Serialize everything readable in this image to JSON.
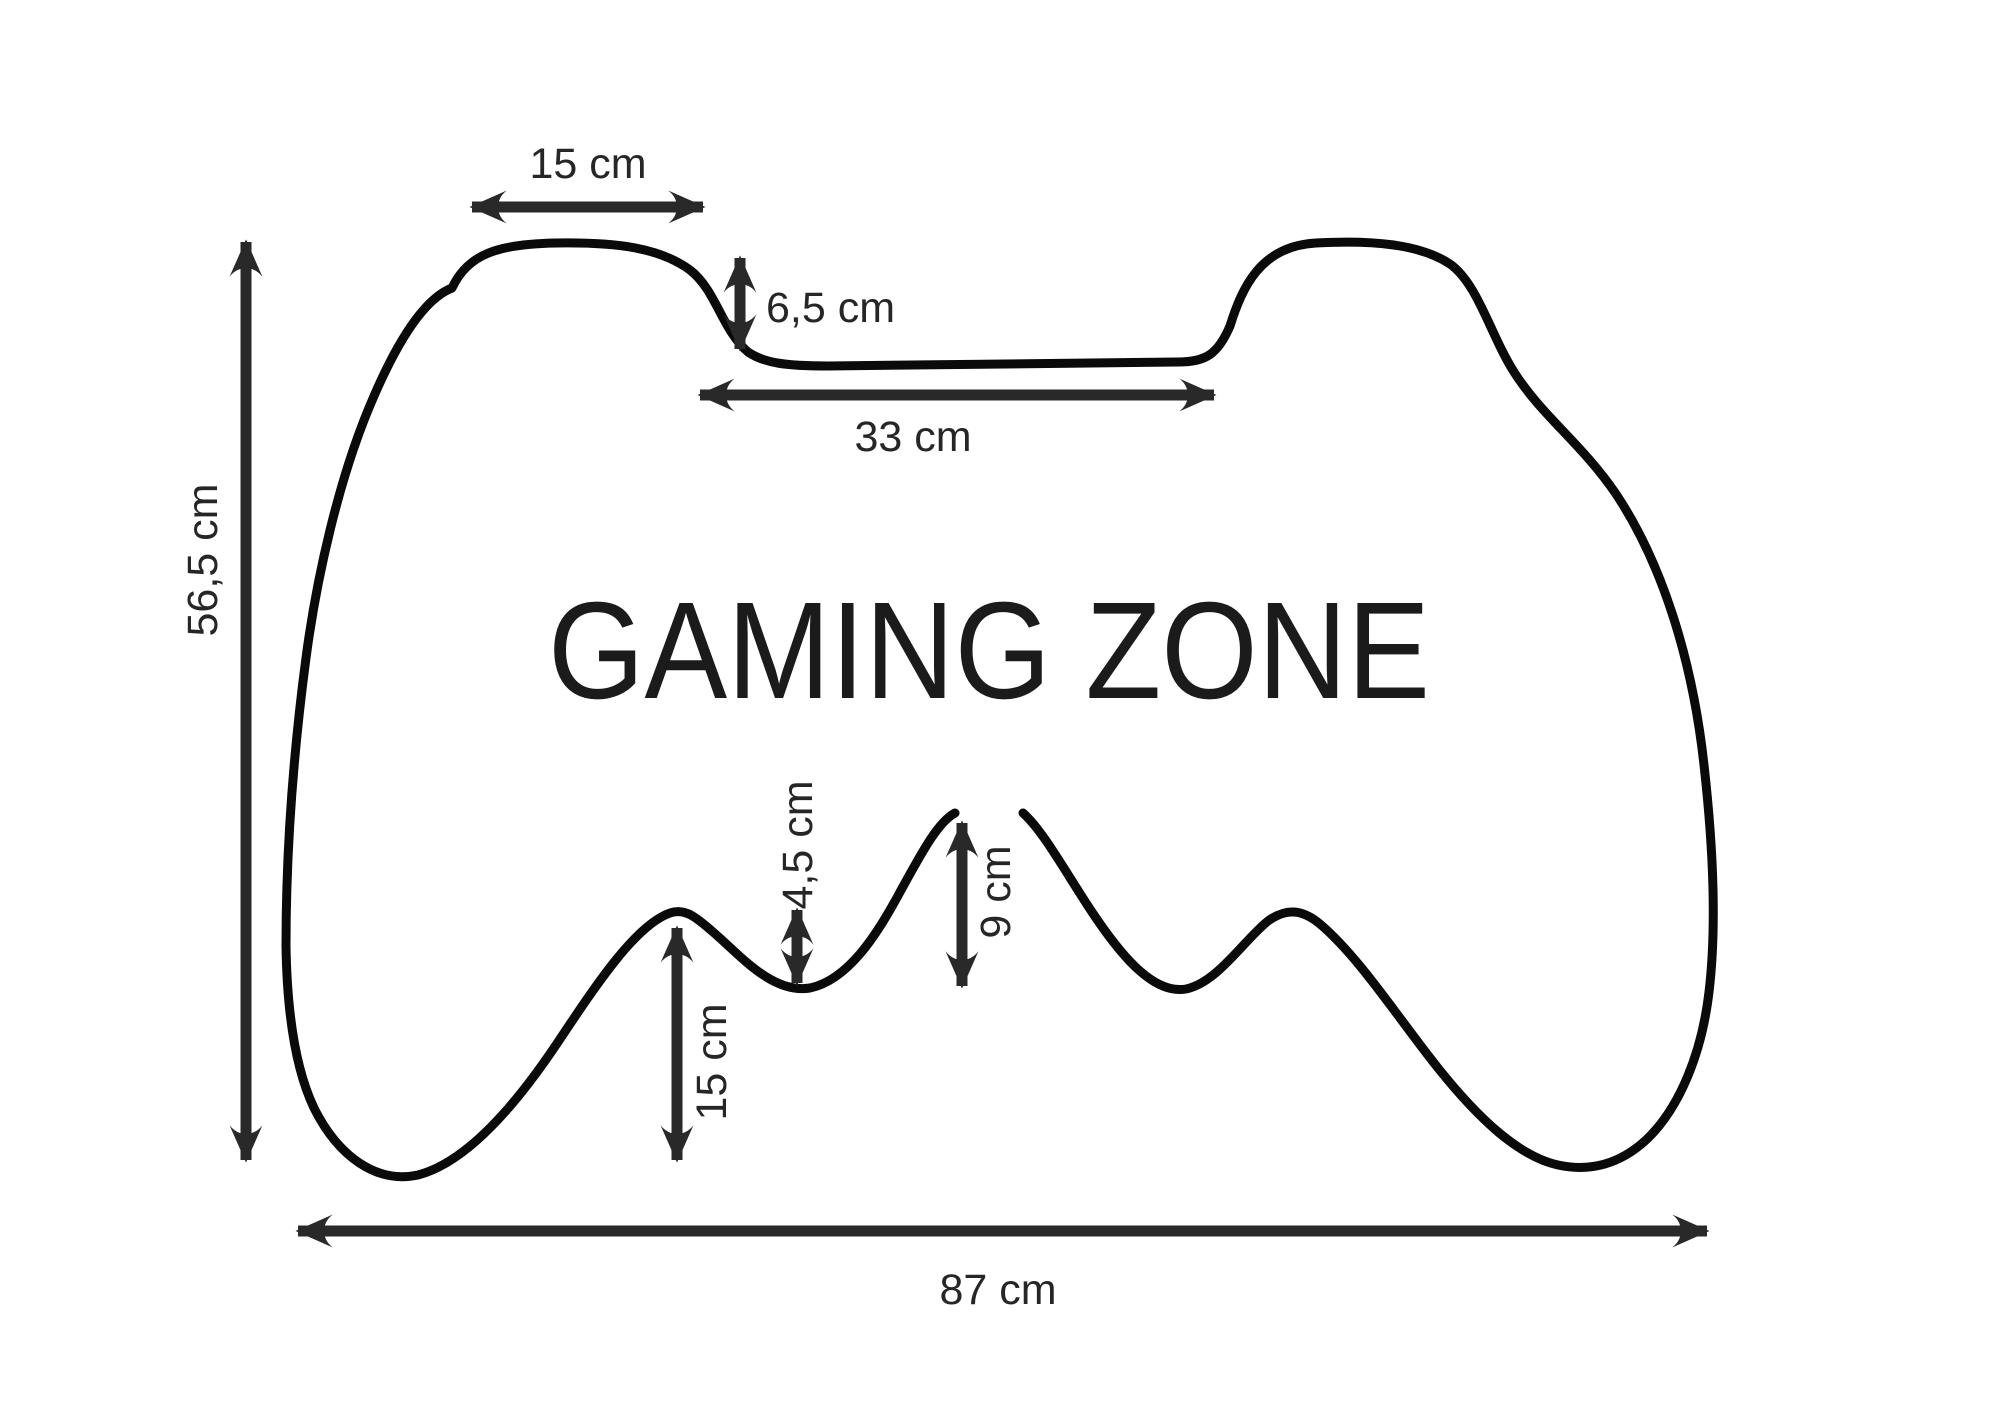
{
  "diagram": {
    "title": "GAMING ZONE",
    "description": "Dimension drawing of a game controller shaped outline",
    "unit": "cm",
    "colors": {
      "background": "#ffffff",
      "outline_ink": "#0a0a0a",
      "dimension_ink": "#292929",
      "label_ink": "#262626"
    },
    "labels": {
      "hump_width": "15 cm",
      "hump_depth": "6,5 cm",
      "middle_width": "33 cm",
      "height": "56,5 cm",
      "grip_height": "15 cm",
      "valley_depth": "4,5 cm",
      "middle_bump_height": "9 cm",
      "width": "87 cm"
    }
  }
}
